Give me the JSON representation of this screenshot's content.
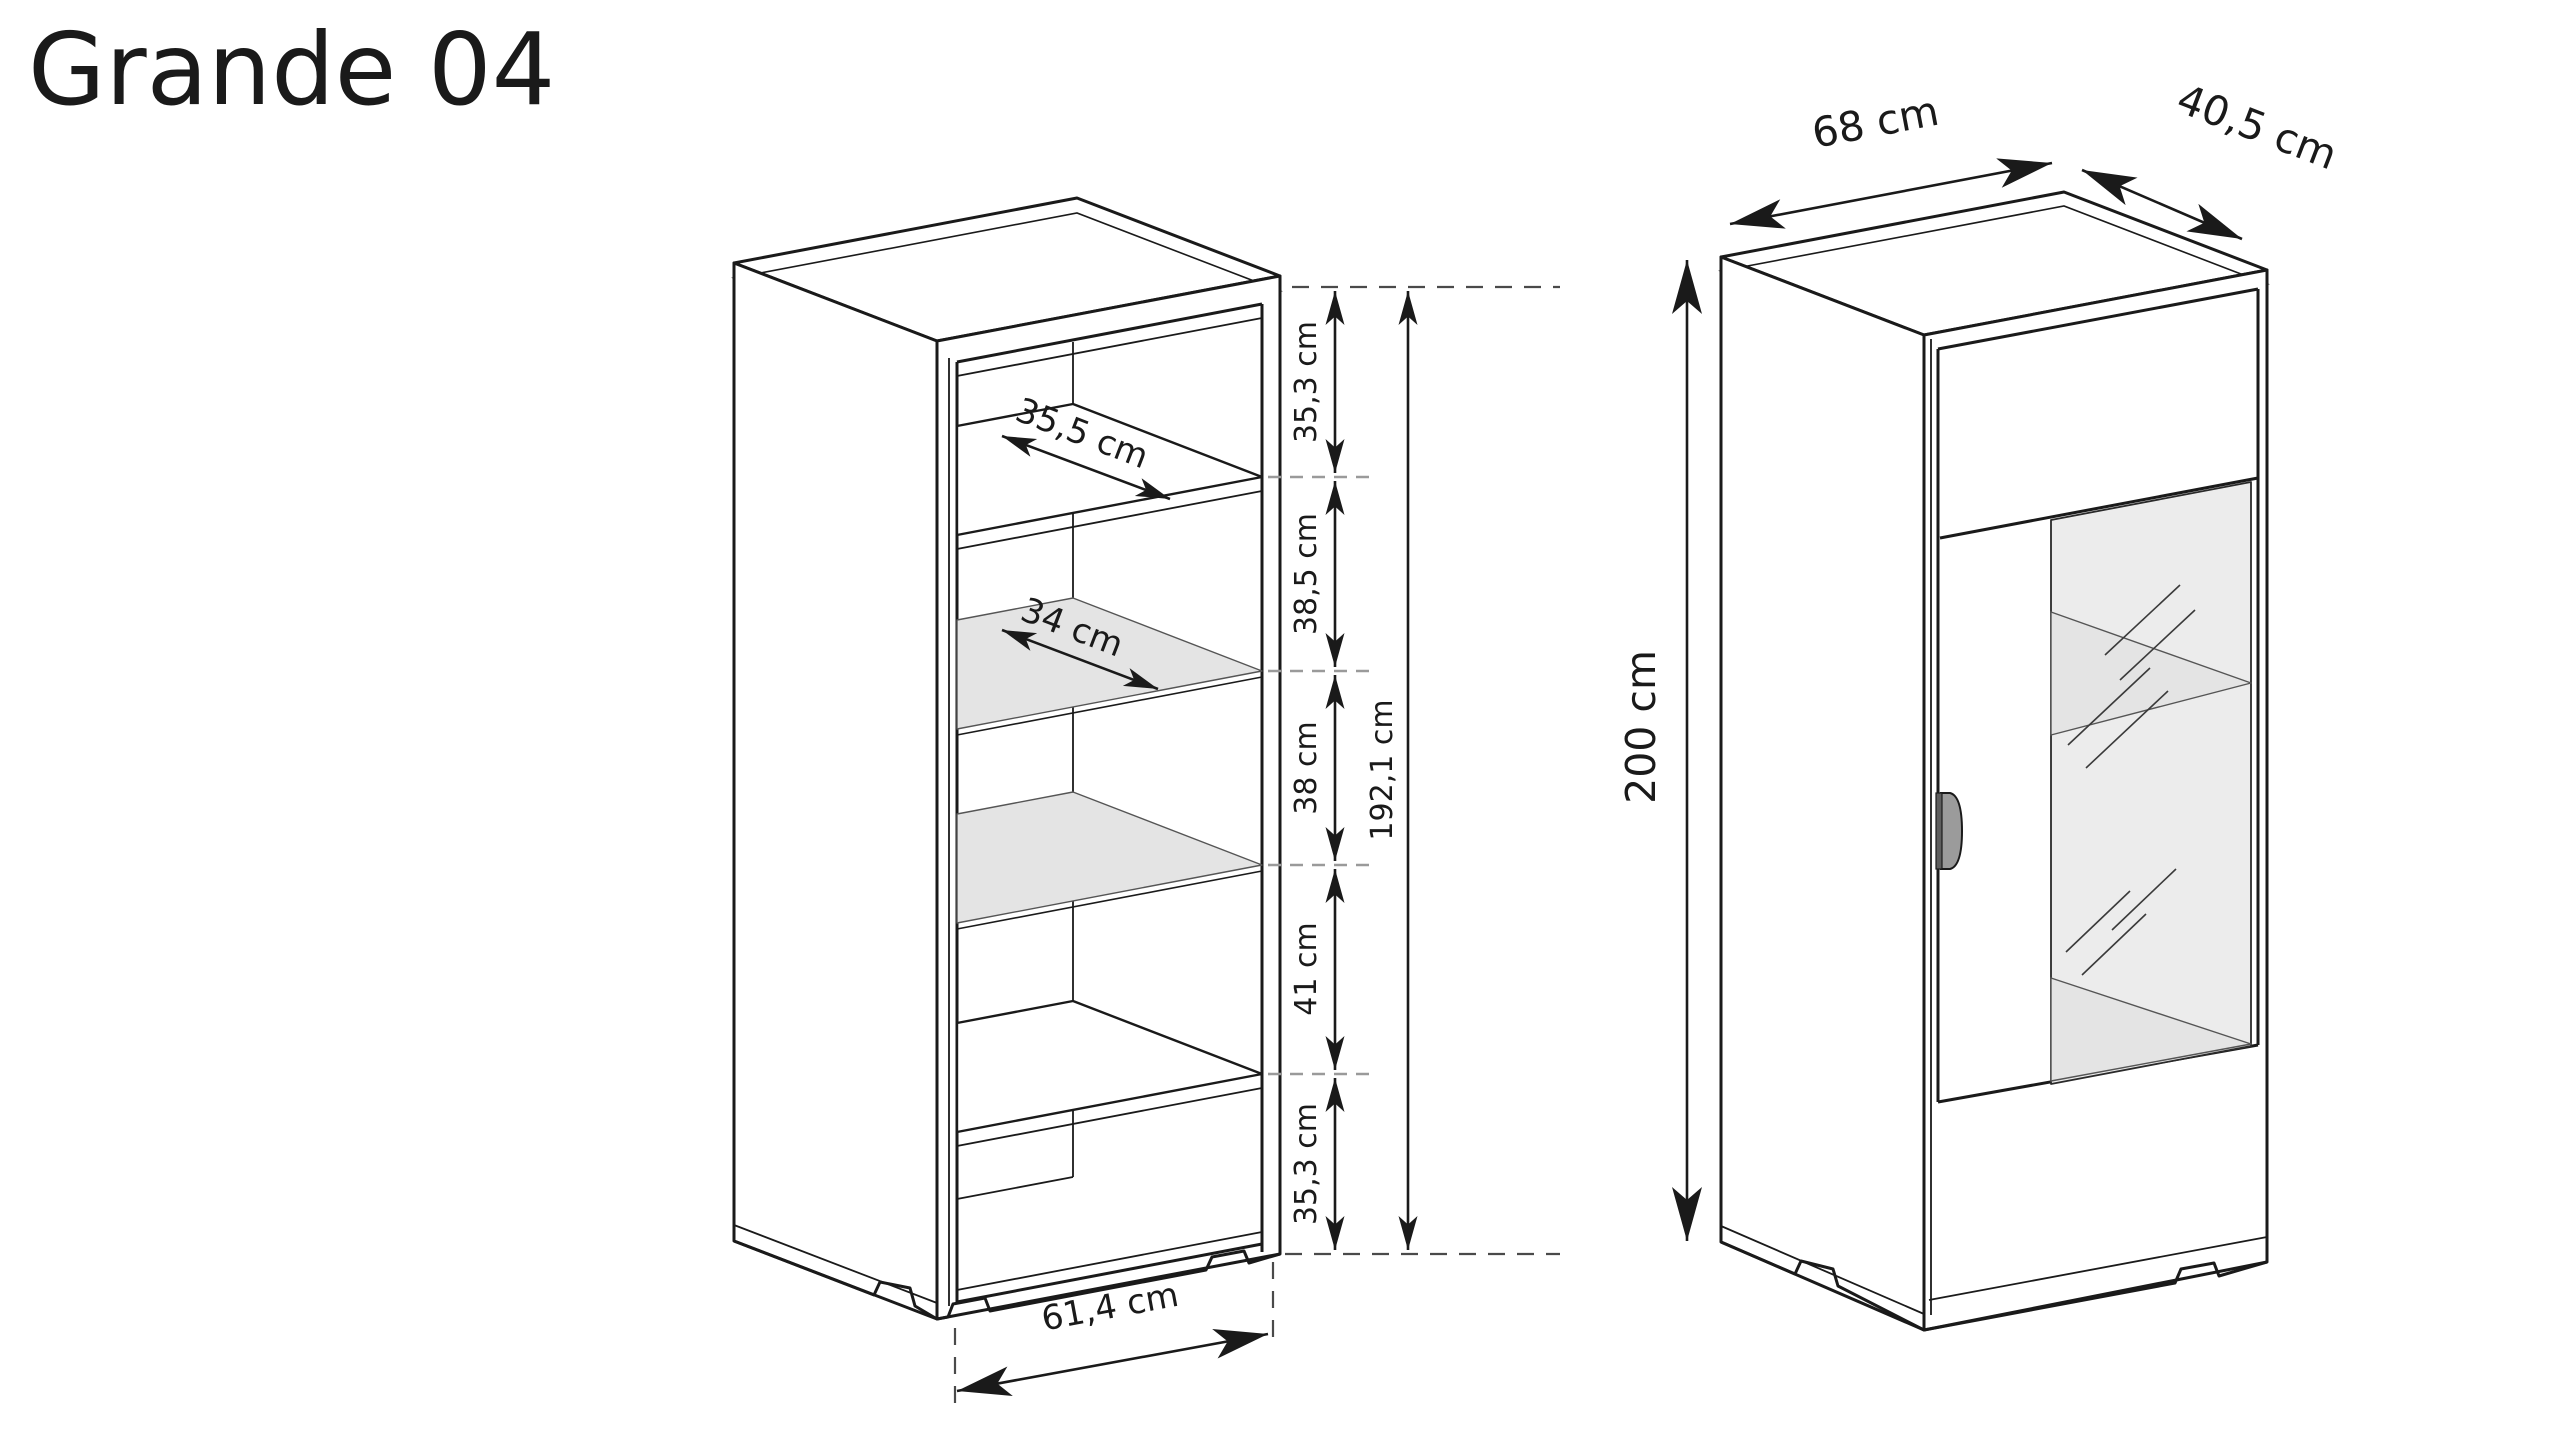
{
  "title": "Grande 04",
  "left_view": {
    "description": "open carcass view with interior dimensions",
    "top_shelf_depth": "35,5 cm",
    "glass_shelf_depth": "34 cm",
    "sections": [
      "35,3 cm",
      "38,5 cm",
      "38 cm",
      "41 cm",
      "35,3 cm"
    ],
    "interior_total_height": "192,1 cm",
    "interior_width": "61,4 cm"
  },
  "right_view": {
    "description": "closed view with glass door and overall dimensions",
    "width": "68 cm",
    "depth": "40,5 cm",
    "height": "200 cm"
  },
  "colors": {
    "line": "#1a1a1a",
    "glass_pane": "#ececec",
    "glass_shelf": "#e4e4e4",
    "handle": "#9b9b9b",
    "dash_gray": "#9a9a9a",
    "background": "#ffffff"
  }
}
